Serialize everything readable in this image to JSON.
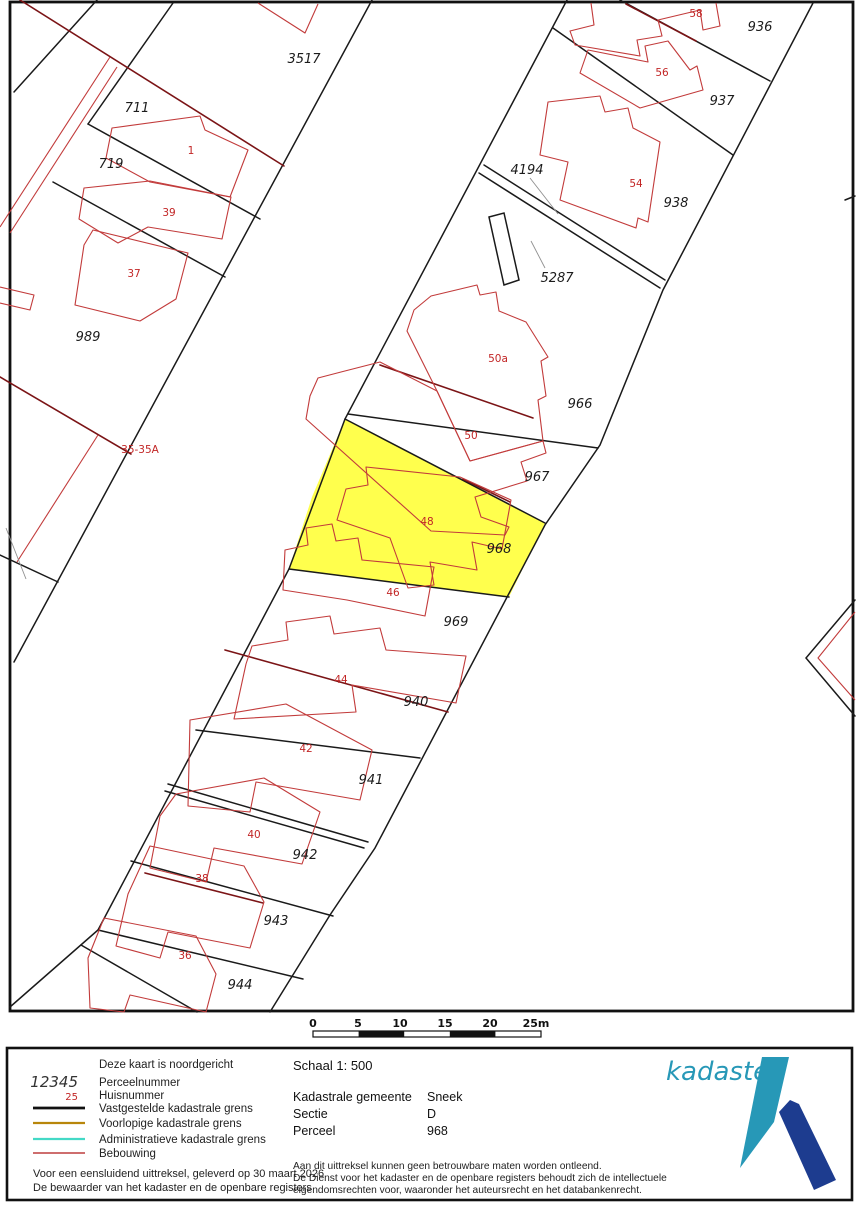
{
  "map": {
    "highlight_parcel": "968",
    "highlight_color": "#FFFF4D",
    "parcel_labels": [
      {
        "text": "3517",
        "x": 304,
        "y": 63
      },
      {
        "text": "711",
        "x": 137,
        "y": 112
      },
      {
        "text": "719",
        "x": 111,
        "y": 168
      },
      {
        "text": "989",
        "x": 88,
        "y": 341
      },
      {
        "text": "936",
        "x": 760,
        "y": 31
      },
      {
        "text": "937",
        "x": 722,
        "y": 105
      },
      {
        "text": "938",
        "x": 676,
        "y": 207
      },
      {
        "text": "4194",
        "x": 527,
        "y": 174
      },
      {
        "text": "5287",
        "x": 557,
        "y": 282
      },
      {
        "text": "966",
        "x": 580,
        "y": 408
      },
      {
        "text": "967",
        "x": 537,
        "y": 481
      },
      {
        "text": "968",
        "x": 499,
        "y": 553
      },
      {
        "text": "969",
        "x": 456,
        "y": 626
      },
      {
        "text": "940",
        "x": 416,
        "y": 706
      },
      {
        "text": "941",
        "x": 371,
        "y": 784
      },
      {
        "text": "942",
        "x": 305,
        "y": 859
      },
      {
        "text": "943",
        "x": 276,
        "y": 925
      },
      {
        "text": "944",
        "x": 240,
        "y": 989
      }
    ],
    "house_labels": [
      {
        "text": "1",
        "x": 191,
        "y": 154
      },
      {
        "text": "39",
        "x": 169,
        "y": 216
      },
      {
        "text": "37",
        "x": 134,
        "y": 277
      },
      {
        "text": "58",
        "x": 696,
        "y": 17
      },
      {
        "text": "56",
        "x": 662,
        "y": 76
      },
      {
        "text": "54",
        "x": 636,
        "y": 187
      },
      {
        "text": "35-35A",
        "x": 140,
        "y": 453
      },
      {
        "text": "50a",
        "x": 498,
        "y": 362
      },
      {
        "text": "50",
        "x": 471,
        "y": 439
      },
      {
        "text": "48",
        "x": 427,
        "y": 525
      },
      {
        "text": "46",
        "x": 393,
        "y": 596
      },
      {
        "text": "44",
        "x": 341,
        "y": 683
      },
      {
        "text": "42",
        "x": 306,
        "y": 752
      },
      {
        "text": "40",
        "x": 254,
        "y": 838
      },
      {
        "text": "38",
        "x": 202,
        "y": 882
      },
      {
        "text": "36",
        "x": 185,
        "y": 959
      }
    ],
    "scale_bar": {
      "ticks": [
        "0",
        "5",
        "10",
        "15",
        "20",
        "25m"
      ]
    }
  },
  "footer": {
    "legend": {
      "north_note": "Deze kaart is noordgericht",
      "sample_parcel_number": "12345",
      "parcel_label": "Perceelnummer",
      "sample_house_number": "25",
      "house_label": "Huisnummer",
      "line_items": [
        {
          "label": "Vastgestelde kadastrale grens",
          "color": "#111111"
        },
        {
          "label": "Voorlopige kadastrale grens",
          "color": "#b8860b"
        },
        {
          "label": "Administratieve kadastrale grens",
          "color": "#43d9c6"
        },
        {
          "label": "Bebouwing",
          "color": "#b01818"
        }
      ],
      "certification_line1": "Voor een eensluidend uittreksel, geleverd op 30 maart 2026",
      "certification_line2": "De bewaarder van het kadaster en de openbare registers"
    },
    "details": {
      "schaal": "Schaal 1: 500",
      "fields": [
        {
          "label": "Kadastrale gemeente",
          "value": "Sneek"
        },
        {
          "label": "Sectie",
          "value": "D"
        },
        {
          "label": "Perceel",
          "value": "968"
        }
      ],
      "disclaimer_lines": [
        "Aan dit uittreksel kunnen geen betrouwbare maten worden ontleend.",
        "De Dienst voor het kadaster en de openbare registers behoudt zich de intellectuele",
        "eigendomsrechten voor, waaronder het auteursrecht en het databankenrecht."
      ]
    },
    "logo": {
      "text": "kadaster",
      "color": "#2798b7",
      "navy": "#1d3c8f"
    }
  }
}
